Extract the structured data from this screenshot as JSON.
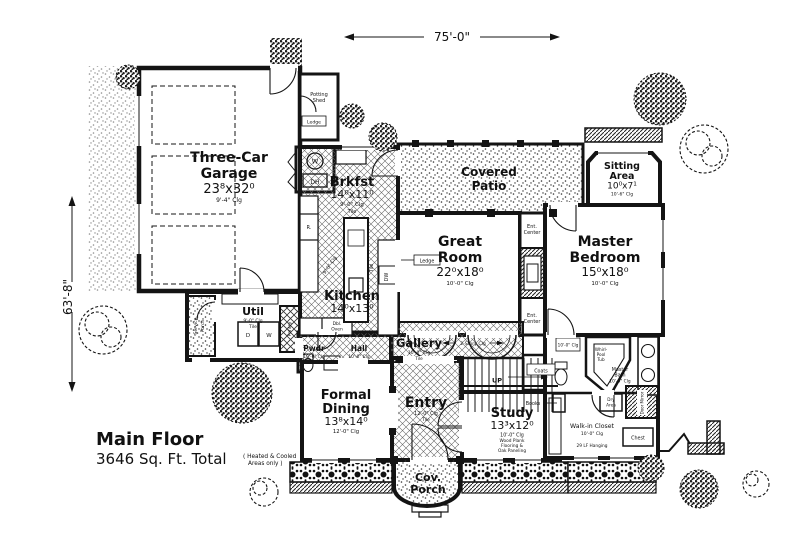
{
  "title": {
    "line1": "Main Floor",
    "line2": "3646 Sq. Ft. Total",
    "note1": "( Heated & Cooled",
    "note2": "Areas only )"
  },
  "dimensions": {
    "width": "75'-0\"",
    "height": "63'-8\""
  },
  "rooms": {
    "garage": {
      "l1": "Three-Car",
      "l2": "Garage",
      "dims": "23⁸x32⁰",
      "clg": "9'-4\" Clg"
    },
    "potting": {
      "l1": "Potting",
      "l2": "Shed"
    },
    "brkfst": {
      "l1": "Brkfst",
      "dims": "14⁰x11⁰",
      "clg": "9'-0\" Clg",
      "floor": "Tile"
    },
    "covered_patio": {
      "l1": "Covered",
      "l2": "Patio"
    },
    "great_room": {
      "l1": "Great",
      "l2": "Room",
      "dims": "22⁰x18⁰",
      "clg": "10'-0\" Clg"
    },
    "sitting": {
      "l1": "Sitting",
      "l2": "Area",
      "dims": "10⁰x7¹",
      "clg": "10'-6\" Clg"
    },
    "master": {
      "l1": "Master",
      "l2": "Bedroom",
      "dims": "15⁰x18⁰",
      "clg": "10'-0\" Clg"
    },
    "kitchen": {
      "l1": "Kitchen",
      "dims": "14⁰x13⁰",
      "clg": "9'-0\" Clg",
      "floor": "Tile"
    },
    "util": {
      "l1": "Util",
      "clg": "9'-0\" Clg",
      "floor": "Tile"
    },
    "service_porch": {
      "l1": "Service",
      "l2": "Porch"
    },
    "pantry": {
      "l1": "Pantry"
    },
    "pwdr": {
      "l1": "Pwdr",
      "clg": "10'-0\" Clg"
    },
    "hall": {
      "l1": "Hall",
      "clg": "10'-0\" Clg"
    },
    "gallery": {
      "l1": "Gallery",
      "clg": "10'-0\" Clg",
      "floor": "Tile"
    },
    "formal_dining": {
      "l1": "Formal",
      "l2": "Dining",
      "dims": "13⁸x14⁰",
      "clg": "12'-0\" Clg"
    },
    "entry": {
      "l1": "Entry",
      "clg": "12'-0\" Clg",
      "floor": "Tile"
    },
    "study": {
      "l1": "Study",
      "dims": "13³x12⁰",
      "clg": "10'-0\" Clg",
      "note1": "Wood Plank",
      "note2": "Flooring &",
      "note3": "Oak Paneling"
    },
    "cov_porch": {
      "l1": "Cov.",
      "l2": "Porch"
    },
    "master_bath": {
      "l1": "Master",
      "l2": "Bath",
      "clg": "10'-0\" Clg"
    },
    "walkin": {
      "l1": "Walk-in Closet",
      "clg": "10'-0\" Clg",
      "note": "29 LF Hanging"
    }
  },
  "labels": {
    "up": "UP",
    "coats": "Coats",
    "books": "Books",
    "two_story": "2-Story Clg",
    "ent_l1": "Ent.",
    "ent_l2": "Center",
    "ledge": "Ledge",
    "whirl1": "Whirl-",
    "whirl2": "Pool",
    "whirl3": "Tub",
    "dry1": "Dry",
    "dry2": "Area",
    "door_mirror": "Door Mirror",
    "chest": "Chest",
    "w": "W",
    "dh": "DH",
    "d": "D",
    "dw": "DW",
    "range": "R.",
    "dbl1": "Dbl.",
    "dbl2": "Oven",
    "clg_10": "10'-0\" Clg"
  },
  "colors": {
    "ink": "#141414",
    "paper": "#ffffff"
  }
}
